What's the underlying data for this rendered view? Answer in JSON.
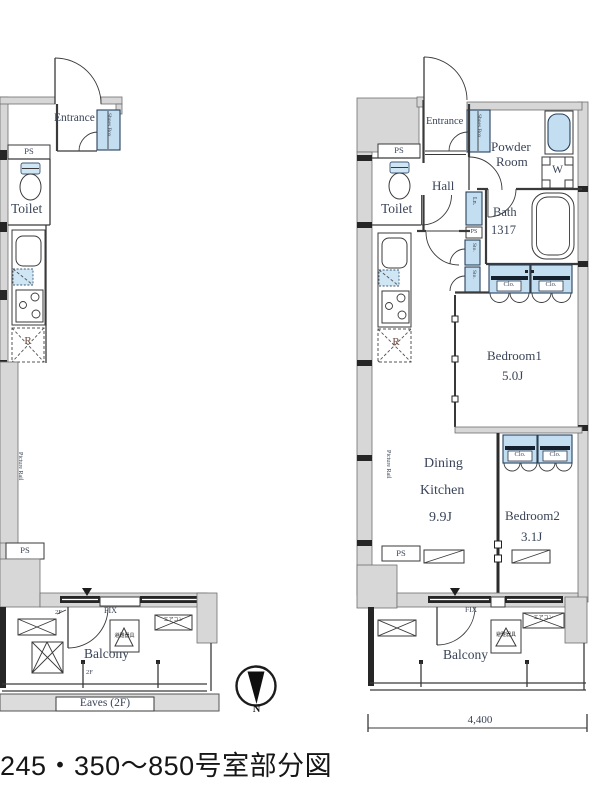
{
  "caption": "245・350〜850号室部分図",
  "compass": {
    "north": "N"
  },
  "dimensions": {
    "bottom_width": "4,400"
  },
  "colors": {
    "fixture_blue": "#c3def0",
    "wall_gray": "#d7d7d7",
    "line": "#3a3a3a",
    "label_text": "#3a4458"
  },
  "left_plan": {
    "entrance": "Entrance",
    "shoes_box": "Shoes Box",
    "ps_top": "PS",
    "toilet": "Toilet",
    "fridge": "R",
    "picture_rail": "Picture Rail",
    "ps_bottom": "PS",
    "fix": "FIX",
    "floor_mark_door": "2F",
    "floor_mark_balcony": "2F",
    "hatch": "避難器具",
    "aircon": "エアコン",
    "balcony": "Balcony",
    "eaves": "Eaves (2F)"
  },
  "right_plan": {
    "entrance": "Entrance",
    "shoes_box": "Shoes Box",
    "powder_room_line1": "Powder",
    "powder_room_line2": "Room",
    "washer": "W",
    "ps_top": "PS",
    "toilet": "Toilet",
    "hall": "Hall",
    "linen": "Ln.",
    "ps_mid": "PS",
    "sto_upper": "Sto.",
    "sto_lower": "Sto.",
    "bath": "Bath",
    "bath_size": "1317",
    "clo_1": "Clo.",
    "clo_2": "Clo.",
    "bedroom1": "Bedroom1",
    "bedroom1_size": "5.0J",
    "dining_line1": "Dining",
    "dining_line2": "Kitchen",
    "dining_size": "9.9J",
    "clo_3": "Clo.",
    "clo_4": "Clo.",
    "bedroom2": "Bedroom2",
    "bedroom2_size": "3.1J",
    "fridge": "R",
    "picture_rail": "Picture Rail",
    "ps_bottom": "PS",
    "fix": "FIX",
    "hatch": "避難器具",
    "aircon": "エアコン",
    "balcony": "Balcony"
  }
}
